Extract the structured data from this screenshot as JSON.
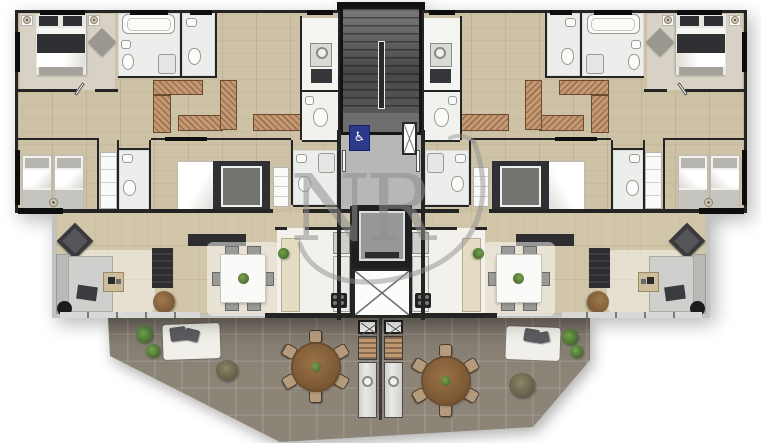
{
  "watermark": {
    "text": "NR",
    "color": "#8f8f8f"
  },
  "scene": {
    "kind": "architectural floor plan, top-down 3D render",
    "units": 2,
    "symmetry": "two identical apartments mirrored around a central stair/elevator core",
    "large_shared_terrace": true
  },
  "palette": {
    "background": "#ffffff",
    "wood_floor": "#cec2a6",
    "wood_floor_lower": "#d2c6aa",
    "carpet": "#d8d2c6",
    "bath_tile": "#eceeeb",
    "wall_dark": "#242424",
    "frame_light": "#c2c2c0",
    "closet_wood": "#c49a76",
    "terrace_tile": "#8d8478",
    "stair_gray": "#5a5a5a",
    "lobby_gray": "#b7b7b5",
    "elevator_car": "#98989a",
    "accessibility_blue": "#2c3a8c",
    "sofa_gray": "#c9c9c7",
    "bed_dark": "#2f2f34",
    "bed_white": "#f6f6f3",
    "dining_table_white": "#fafaf8",
    "terrace_table_wood": "#8a653f",
    "greenery": "#4e7a3a"
  },
  "core": {
    "accessibility_symbol": "♿",
    "features": [
      "switchback staircase",
      "central handrail",
      "elevator with car",
      "elevator shaft marked with X",
      "accessible-unit signage"
    ]
  },
  "unit_rooms": [
    "master bedroom with double bed, nightstands, ottoman",
    "master bathroom with bathtub",
    "guest WC",
    "walk-through closet (hatched cabinetry)",
    "second bedroom with two single beds",
    "second bathroom",
    "middle suite with double bed and wardrobe",
    "suite bathroom with shower",
    "laundry room with washer",
    "laundry WC",
    "kitchen with pantry, fridge and cooktop",
    "living room with chaise sofa, armchair, TV console",
    "dining area with square table and six chairs"
  ],
  "terrace": {
    "dining_sets": [
      {
        "shape": "round wooden table",
        "seats": 6
      },
      {
        "shape": "round wooden table",
        "seats": 6
      }
    ],
    "barbecue_counters": 2,
    "loungers": 2,
    "planters": 6,
    "floor": "large gray tiles with angled outer edges"
  }
}
